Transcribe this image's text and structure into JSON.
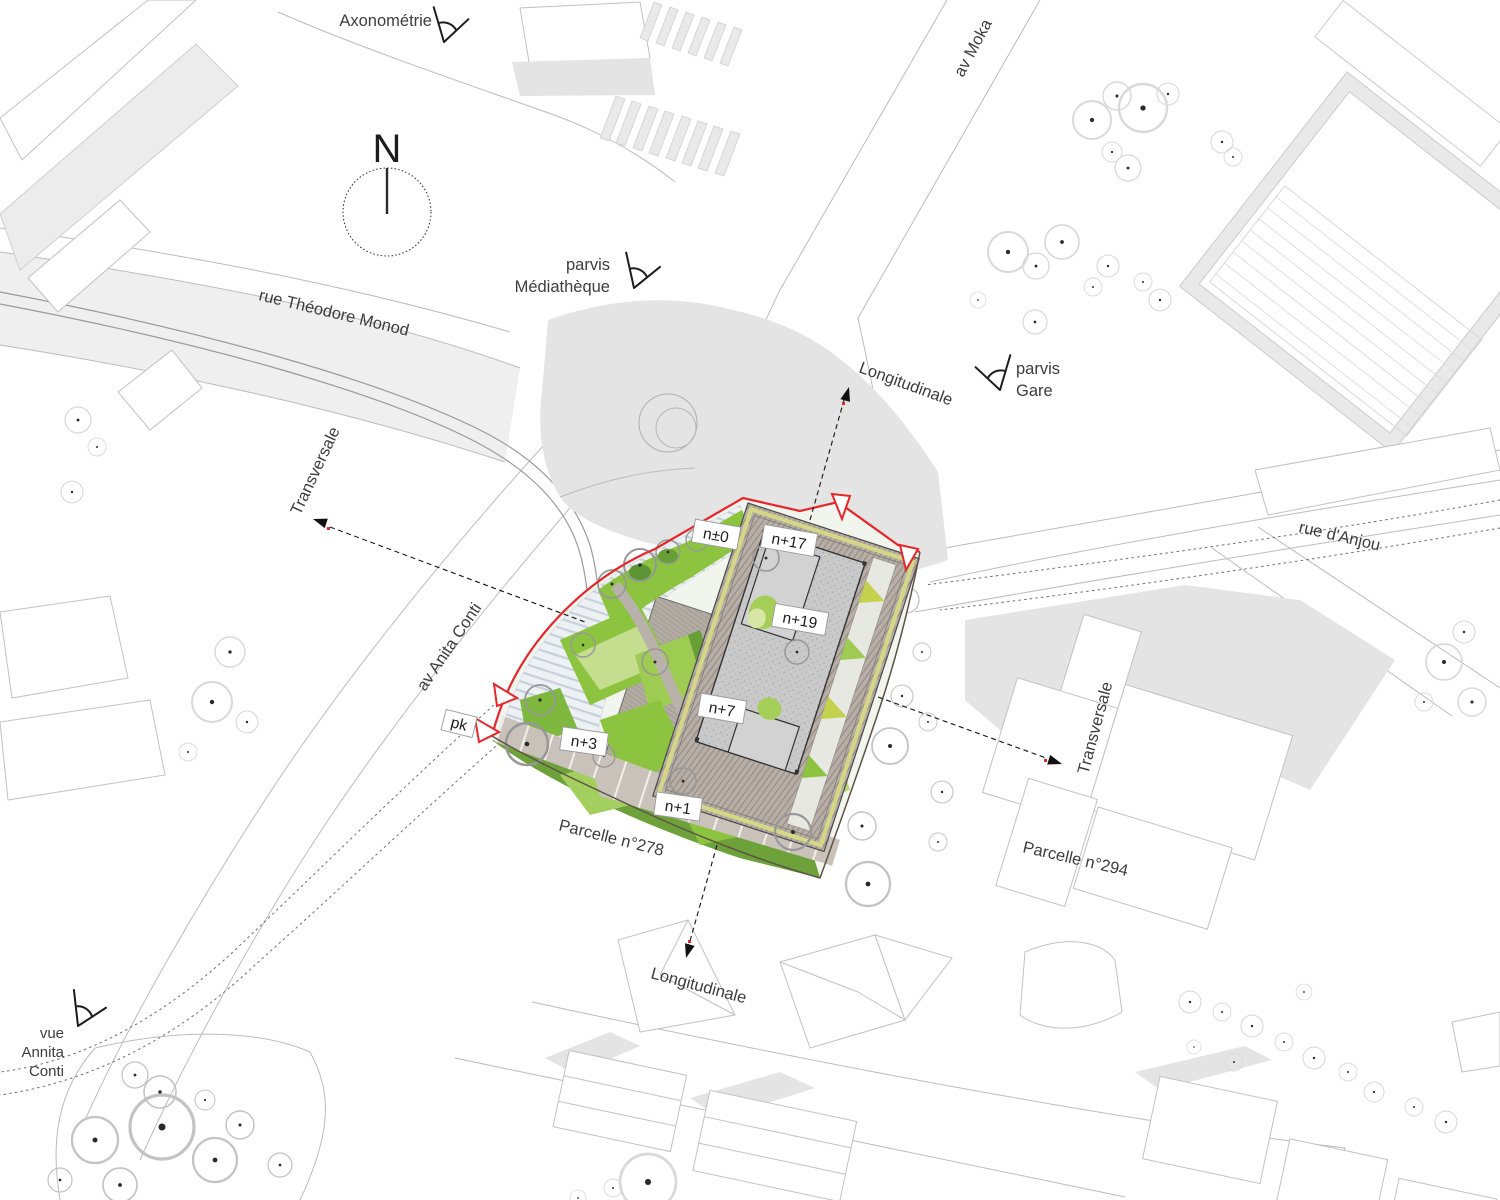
{
  "drawing": {
    "type": "architectural site plan",
    "north_label": "N"
  },
  "streets": {
    "rue_theodore_monod": "rue Théodore Monod",
    "av_moka": "av Moka",
    "rue_danjou": "rue d'Anjou",
    "av_anita_conti": "av Anita Conti"
  },
  "sections": {
    "longitudinale_top": "Longitudinale",
    "longitudinale_bottom": "Longitudinale",
    "transversale_left": "Transversale",
    "transversale_right": "Transversale"
  },
  "view_markers": {
    "axonometrie": "Axonométrie",
    "parvis_mediatheque": {
      "line1": "parvis",
      "line2": "Médiathèque"
    },
    "parvis_gare": {
      "line1": "parvis",
      "line2": "Gare"
    },
    "vue_annita_conti": {
      "line1": "vue",
      "line2": "Annita",
      "line3": "Conti"
    },
    "pk": "pk"
  },
  "parcels": {
    "p278": "Parcelle n°278",
    "p294": "Parcelle n°294"
  },
  "levels": {
    "n0": "n±0",
    "n17": "n+17",
    "n19": "n+19",
    "n7": "n+7",
    "n3": "n+3",
    "n1": "n+1"
  },
  "colors": {
    "site_boundary": "#e8262a",
    "green_light": "#c4dd8e",
    "green_mid": "#8cc43f",
    "green_dark": "#6da23a",
    "terrace_yellow": "#d9d464",
    "roof_hatch": "#b7afa7",
    "tower_roof": "#c9c9c9",
    "background_building": "#ececec",
    "line_gray": "#bcbcbc"
  }
}
